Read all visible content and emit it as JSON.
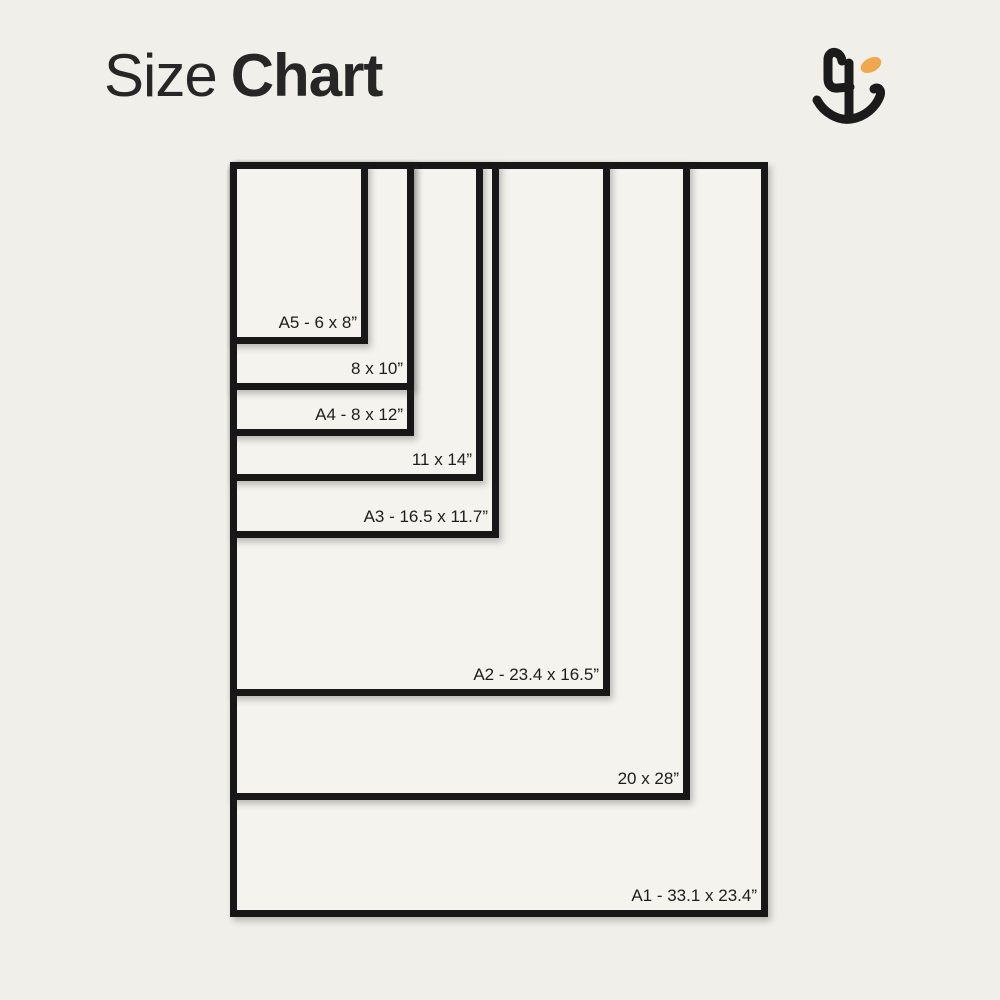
{
  "page": {
    "background_color": "#f0efe9"
  },
  "header": {
    "title_regular": "Size",
    "title_bold": "Chart",
    "title_color": "#262626"
  },
  "logo": {
    "name": "brand-monogram",
    "ink_color": "#1b1b1b",
    "accent_color": "#f0a84f"
  },
  "chart_data": {
    "type": "nested-size-diagram",
    "title": "Size Chart",
    "unit": "inches",
    "anchor": "top-left",
    "origin_px": {
      "left": 230,
      "top": 162
    },
    "px_per_inch_x": 23.0,
    "px_per_inch_y": 22.8,
    "frame_color": "#171717",
    "frame_fill": "#f4f3ee",
    "label_color": "#1d1d1d",
    "sizes": [
      {
        "id": "a5",
        "label": "A5 - 6 x 8”",
        "width_in": 6,
        "height_in": 8
      },
      {
        "id": "8x10",
        "label": "8 x 10”",
        "width_in": 8,
        "height_in": 10
      },
      {
        "id": "a4",
        "label": "A4 - 8 x 12”",
        "width_in": 8,
        "height_in": 12
      },
      {
        "id": "11x14",
        "label": "11 x 14”",
        "width_in": 11,
        "height_in": 14
      },
      {
        "id": "a3",
        "label": "A3 - 16.5 x 11.7”",
        "width_in": 11.7,
        "height_in": 16.5
      },
      {
        "id": "a2",
        "label": "A2 - 23.4 x 16.5”",
        "width_in": 16.5,
        "height_in": 23.4
      },
      {
        "id": "20x28",
        "label": "20 x 28”",
        "width_in": 20,
        "height_in": 28
      },
      {
        "id": "a1",
        "label": "A1 - 33.1 x 23.4”",
        "width_in": 23.4,
        "height_in": 33.1
      }
    ]
  }
}
